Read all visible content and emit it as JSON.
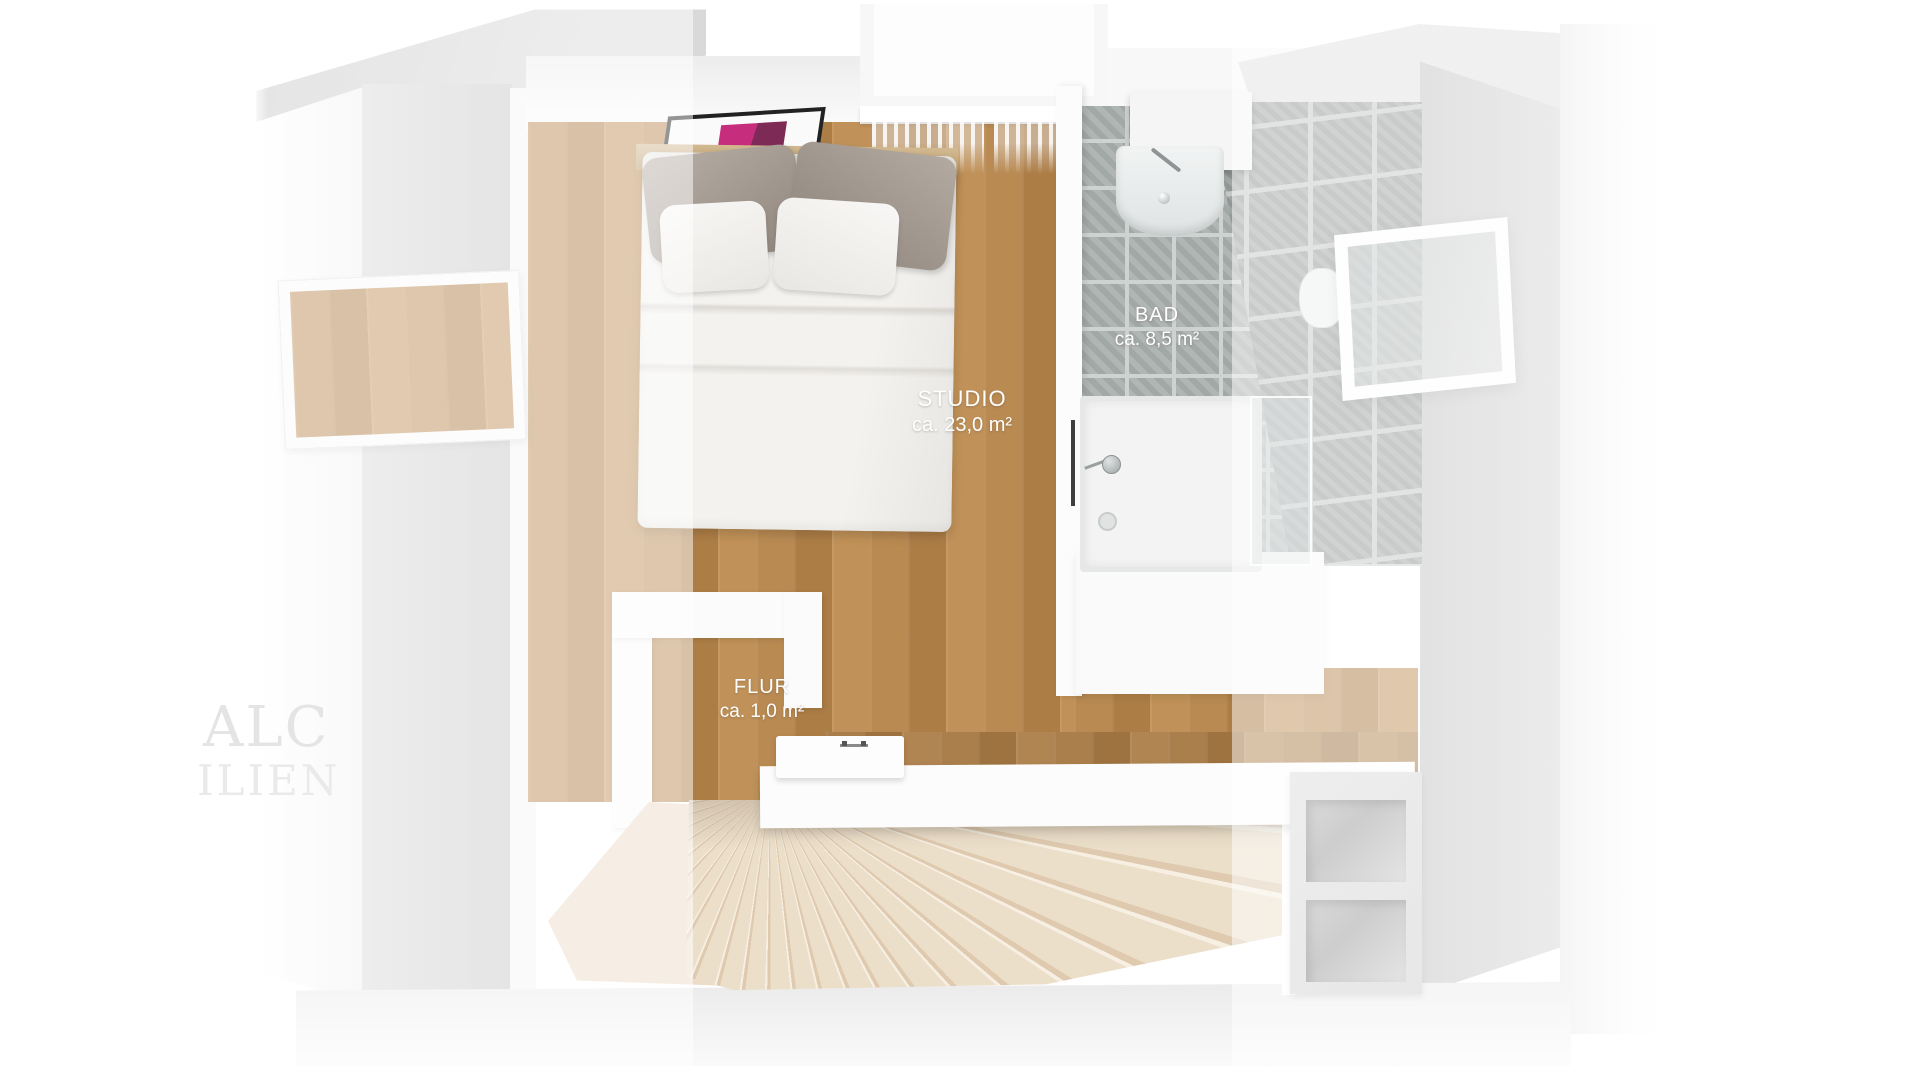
{
  "rooms": [
    {
      "name": "STUDIO",
      "area": "ca. 23,0 m²"
    },
    {
      "name": "BAD",
      "area": "ca. 8,5 m²"
    },
    {
      "name": "FLUR",
      "area": "ca. 1,0 m²"
    }
  ],
  "watermark": {
    "line1": "ALC",
    "line2": "ILIEN"
  },
  "colors": {
    "wood_floor": "#b8894f",
    "tile_floor": "#abb1af",
    "tile_wall": "#9aa09e",
    "wall_gray": "#cfcfcf",
    "stair_beige": "#ecddc8",
    "artwork_pink": "#c62e7d",
    "label_text": "#ffffff"
  }
}
